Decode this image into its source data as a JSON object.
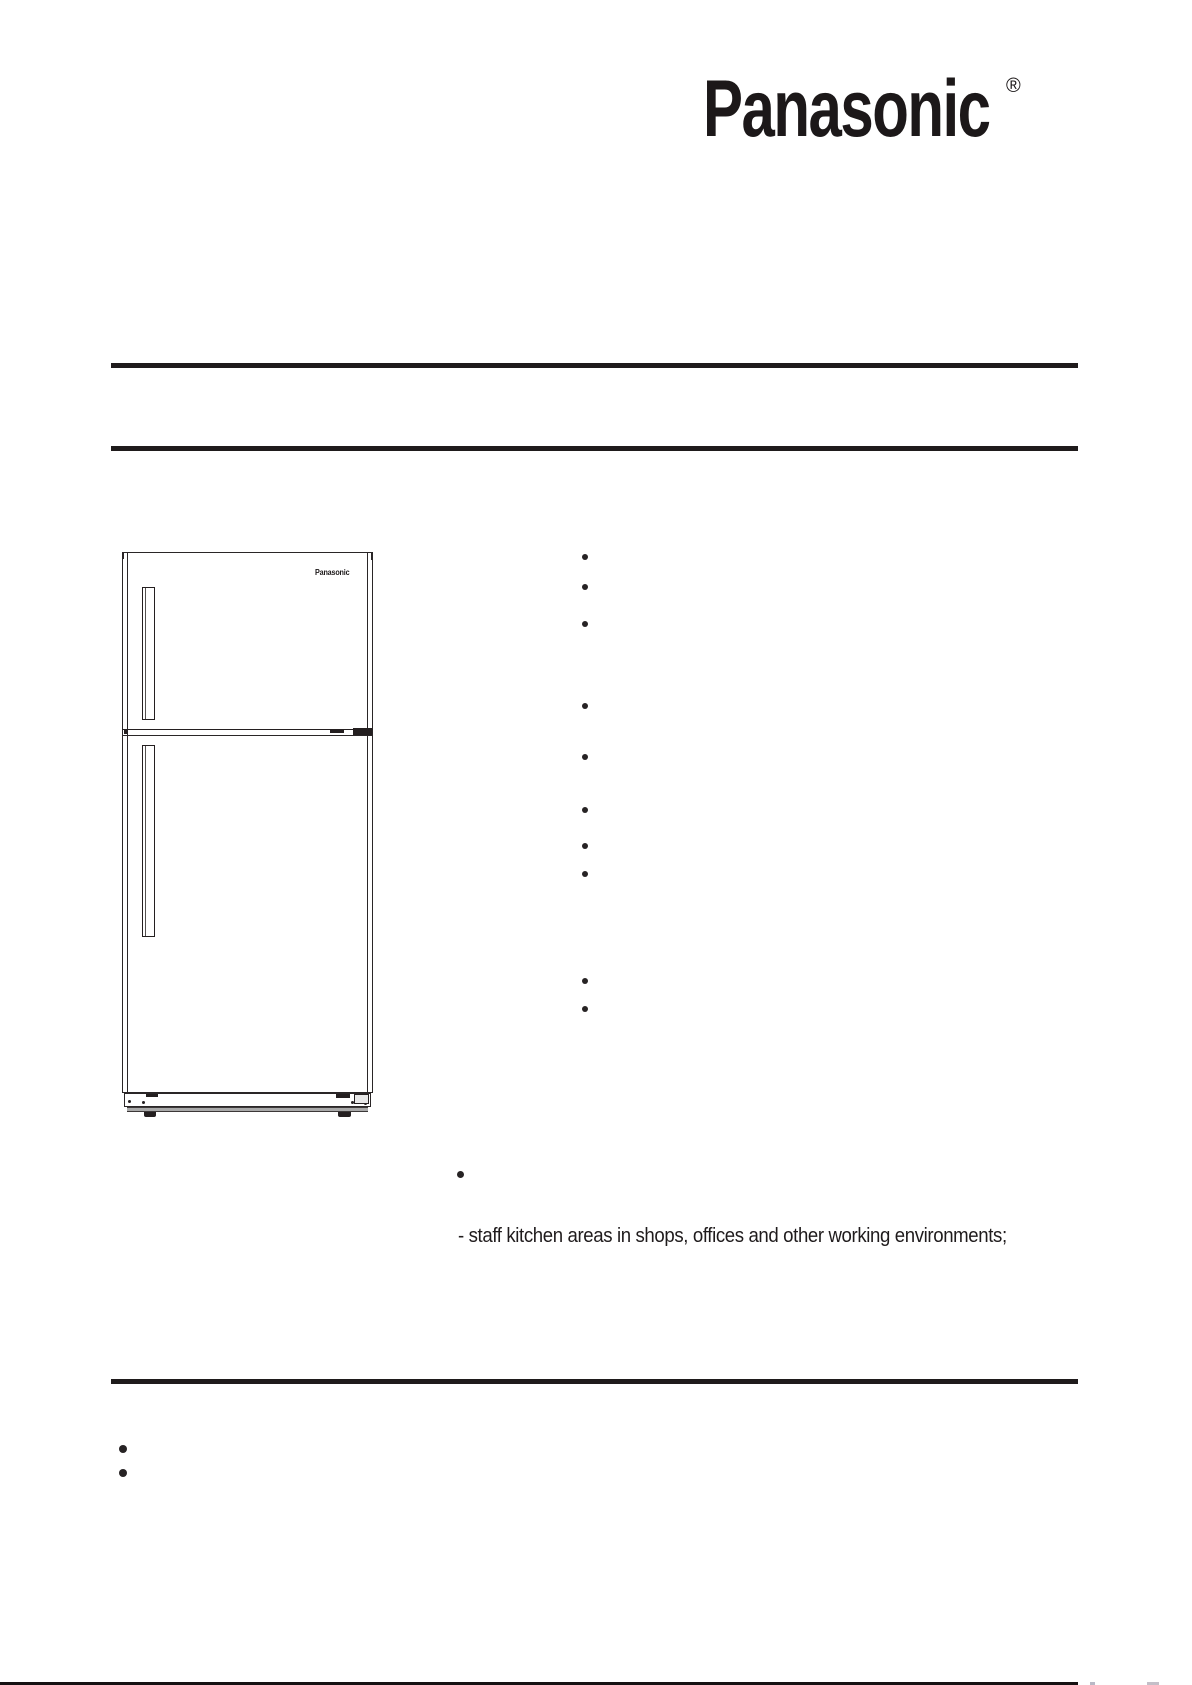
{
  "page": {
    "background": "#ffffff",
    "ink_color": "#211d1e"
  },
  "header": {
    "logo_text": "Panasonic",
    "registered_mark": "®"
  },
  "figure": {
    "description": "top-freezer refrigerator line drawing",
    "door_brand_label": "Panasonic",
    "kick_strip_color": "#a9a9a9"
  },
  "body": {
    "usage_note": "- staff kitchen areas in shops, offices and other working environments;"
  },
  "icons": {
    "bullet": "•"
  }
}
